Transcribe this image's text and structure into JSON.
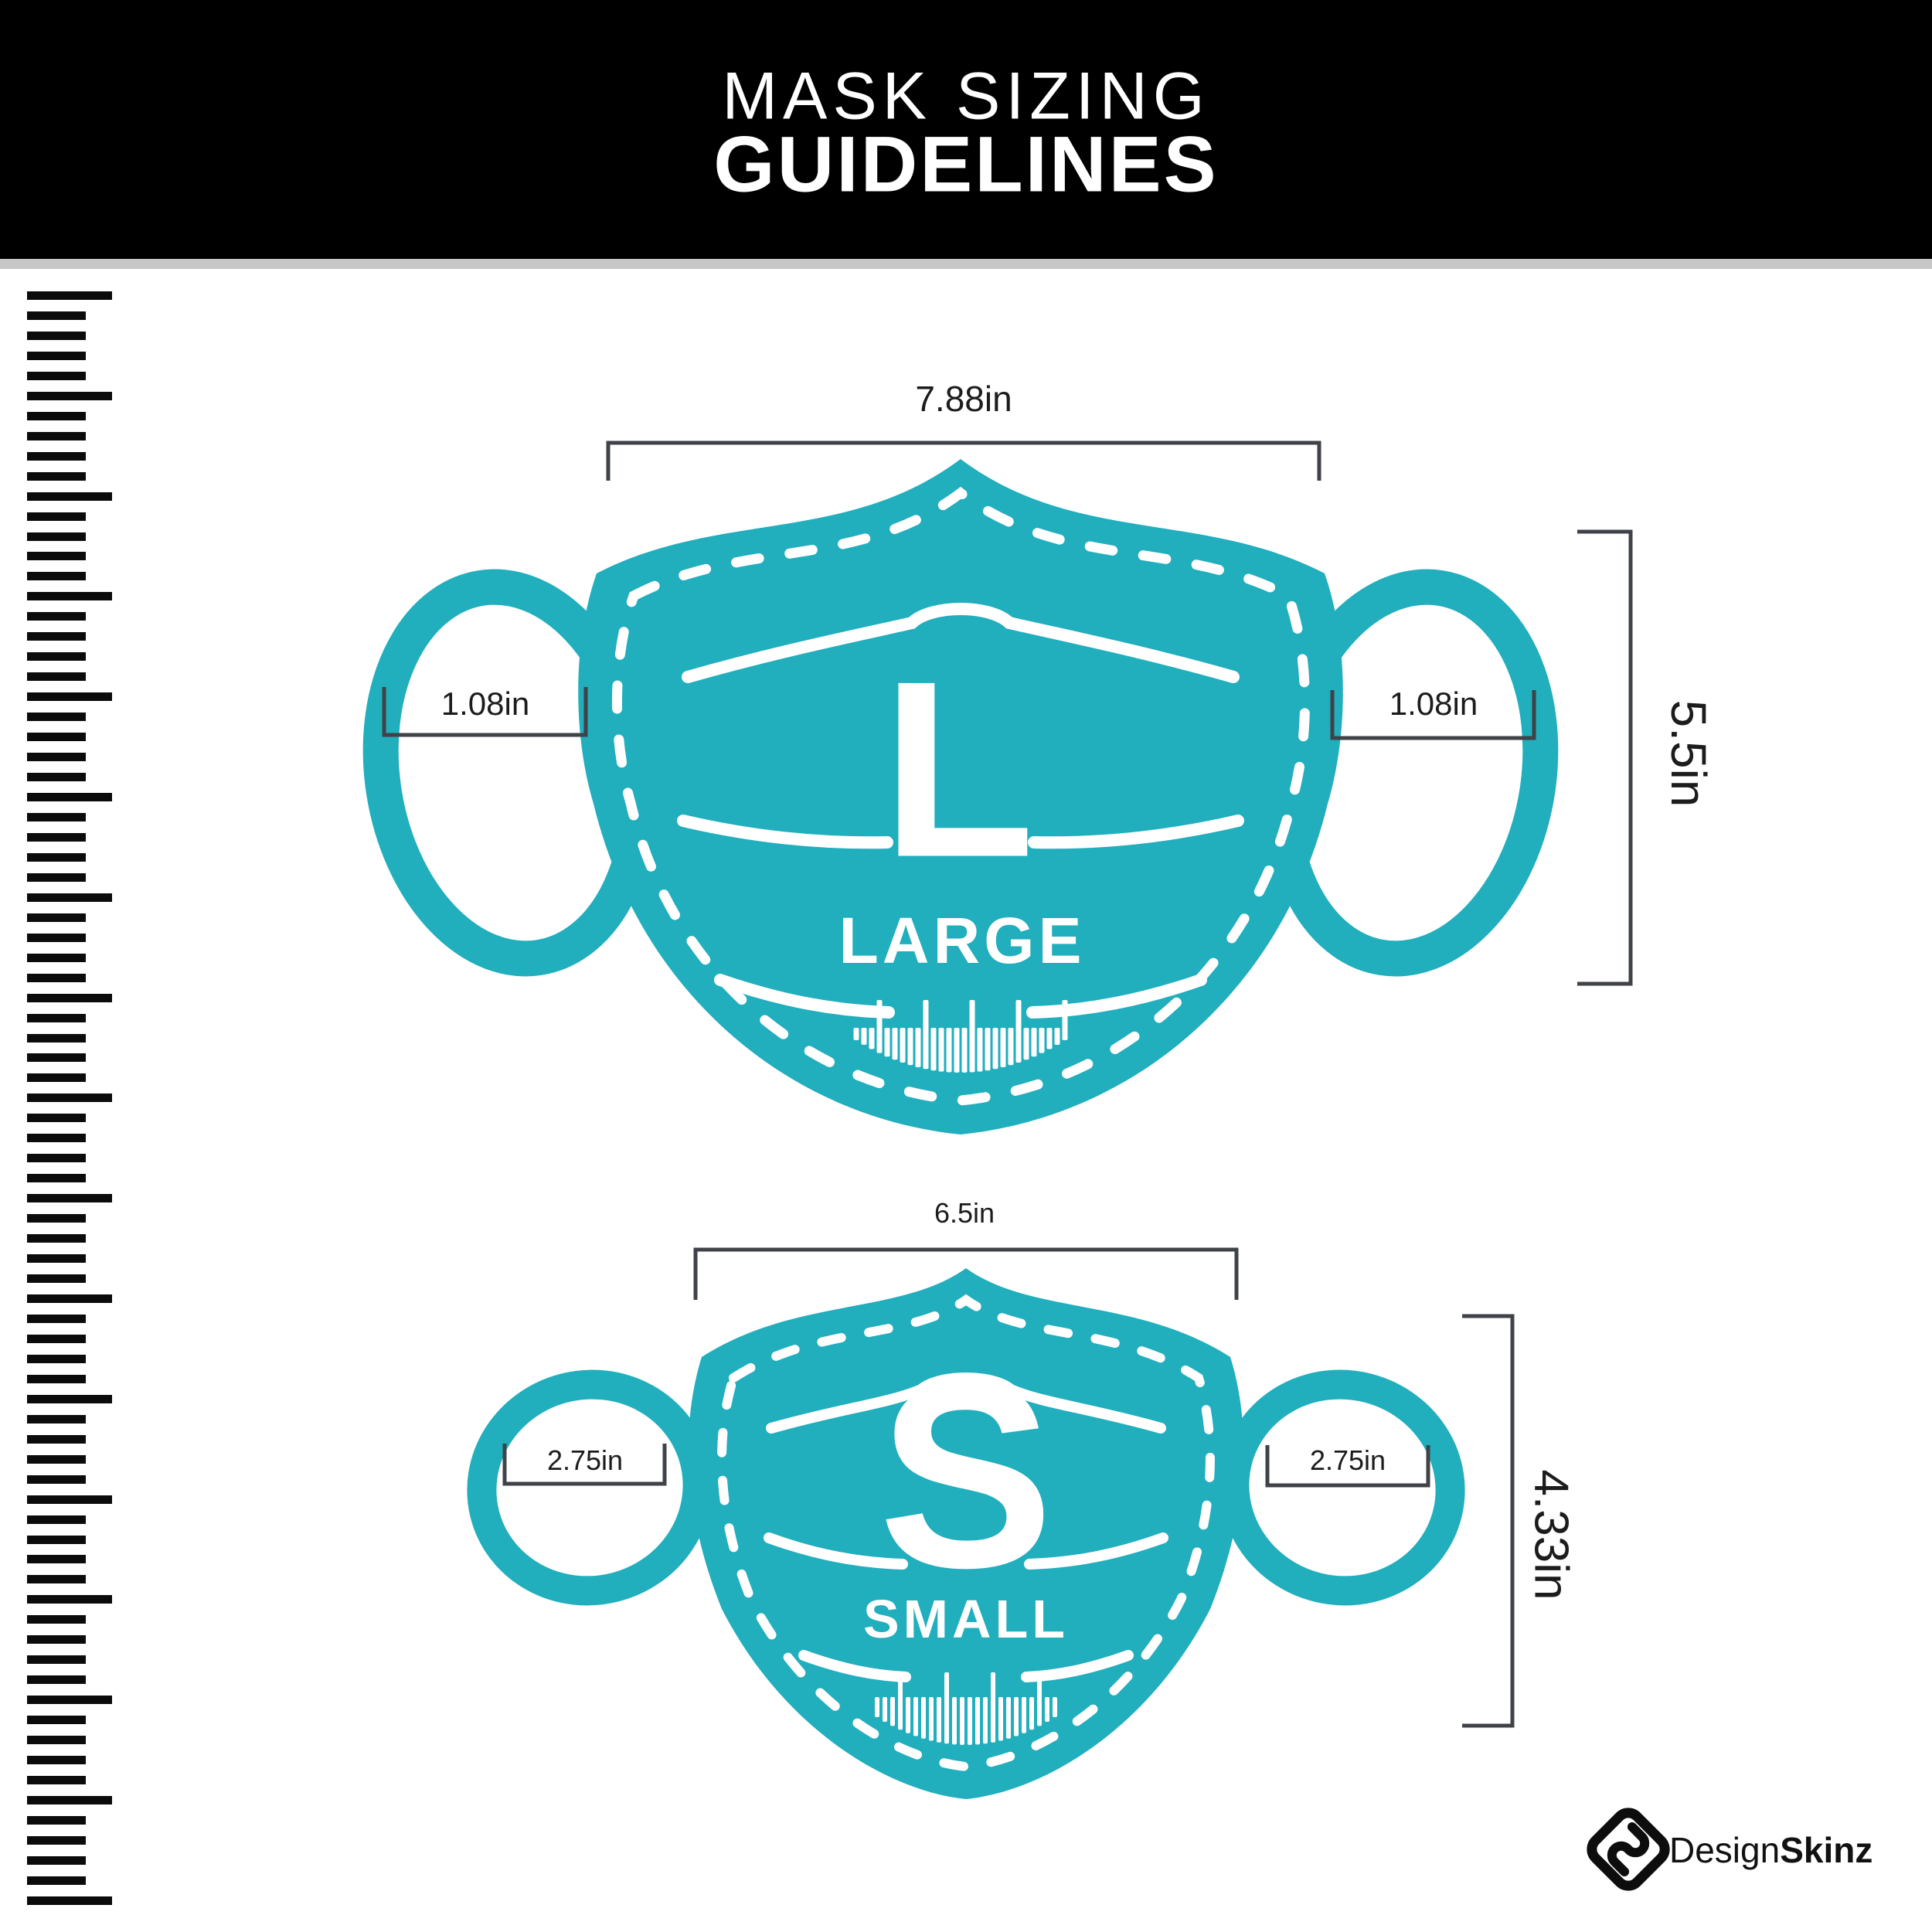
{
  "header": {
    "title_line1": "MASK SIZING",
    "title_line2": "GUIDELINES"
  },
  "large_mask": {
    "letter": "L",
    "size_label": "LARGE",
    "top_width": "7.88in",
    "ear_width_left": "1.08in",
    "ear_width_right": "1.08in",
    "height": "5.5in"
  },
  "small_mask": {
    "letter": "S",
    "size_label": "SMALL",
    "top_width": "6.5in",
    "ear_width_left": "2.75in",
    "ear_width_right": "2.75in",
    "height": "4.33in"
  },
  "footer": {
    "brand_regular": "Design",
    "brand_bold": "Skinz"
  },
  "colors": {
    "mask_teal": "#21AEBD",
    "bracket_gray": "#3f4247",
    "header_bg": "#000000",
    "divider_gray": "#c7c7c7"
  }
}
